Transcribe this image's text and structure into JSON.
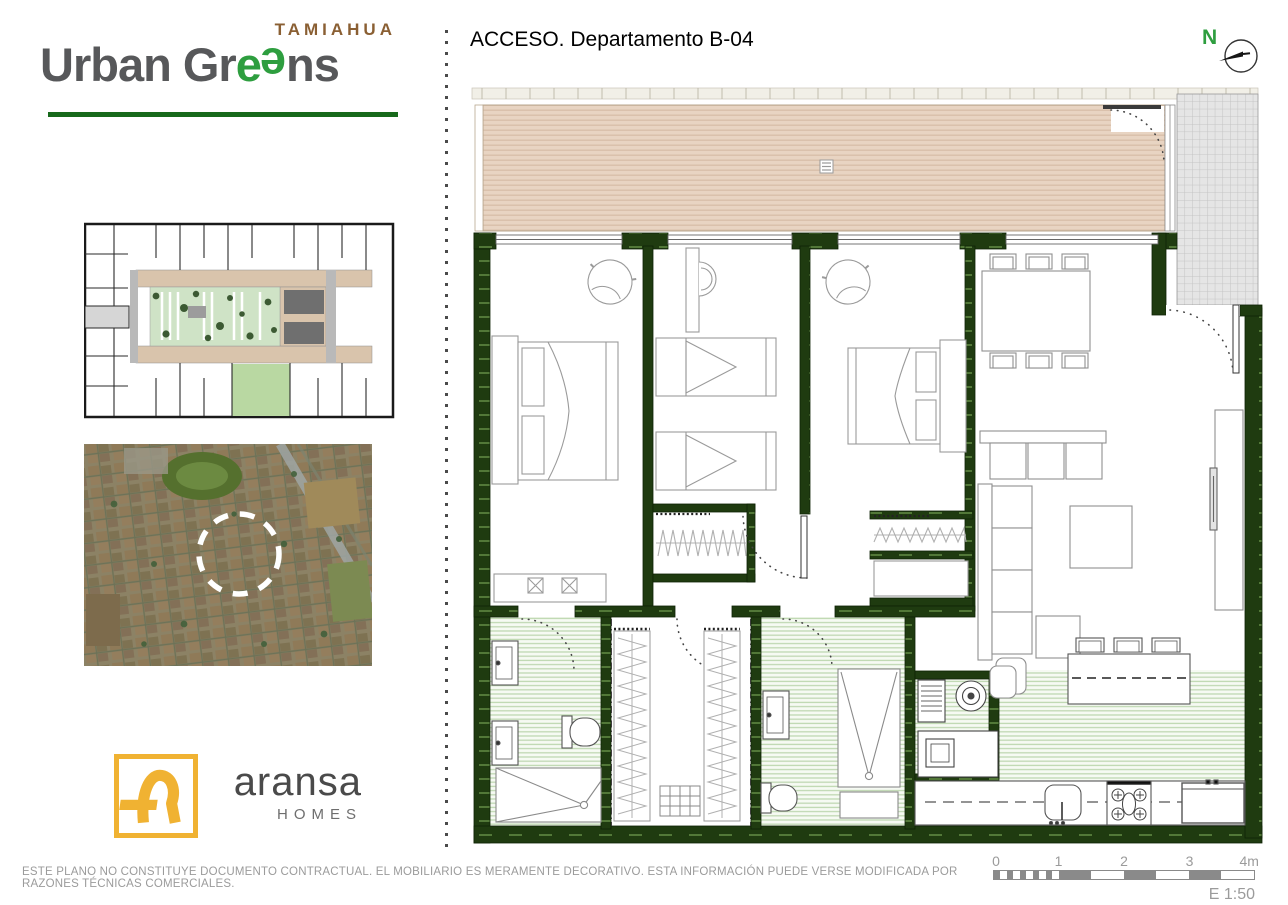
{
  "colors": {
    "wall": "#1f3b10",
    "accentGreen": "#2e9e3f",
    "underline": "#17691b",
    "brown": "#8a5f33",
    "terrace": "#e8d4c2",
    "terraceLine": "#d8bfa9",
    "hatchBg": "#f6faf3",
    "hatchLine": "#bfd8b2",
    "grayHatch": "#e5e5e5",
    "grayHatchLine": "#c4c4c4",
    "yellow": "#f0b232",
    "textDark": "#57585a",
    "textGray": "#9b9b9b",
    "lineGray": "#8a8a8a"
  },
  "brand": {
    "project": "TAMIAHUA",
    "name_pre": "Urban Gr",
    "name_e1": "e",
    "name_e2": "e",
    "name_post": "ns"
  },
  "header": {
    "title": "ACCESO. Departamento B-04",
    "north_label": "N"
  },
  "developer": {
    "name": "aransa",
    "tagline": "HOMES"
  },
  "icons": {
    "north": "compass-circle-with-needle",
    "location": "dashed-circle-marker"
  },
  "footer": {
    "disclaimer": "ESTE PLANO NO CONSTITUYE DOCUMENTO CONTRACTUAL. EL MOBILIARIO ES MERAMENTE DECORATIVO. ESTA INFORMACIÓN PUEDE VERSE MODIFICADA POR RAZONES TÉCNICAS COMERCIALES.",
    "scale_ticks": [
      "0",
      "1",
      "2",
      "3",
      "4m"
    ],
    "scale_label": "E 1:50"
  }
}
